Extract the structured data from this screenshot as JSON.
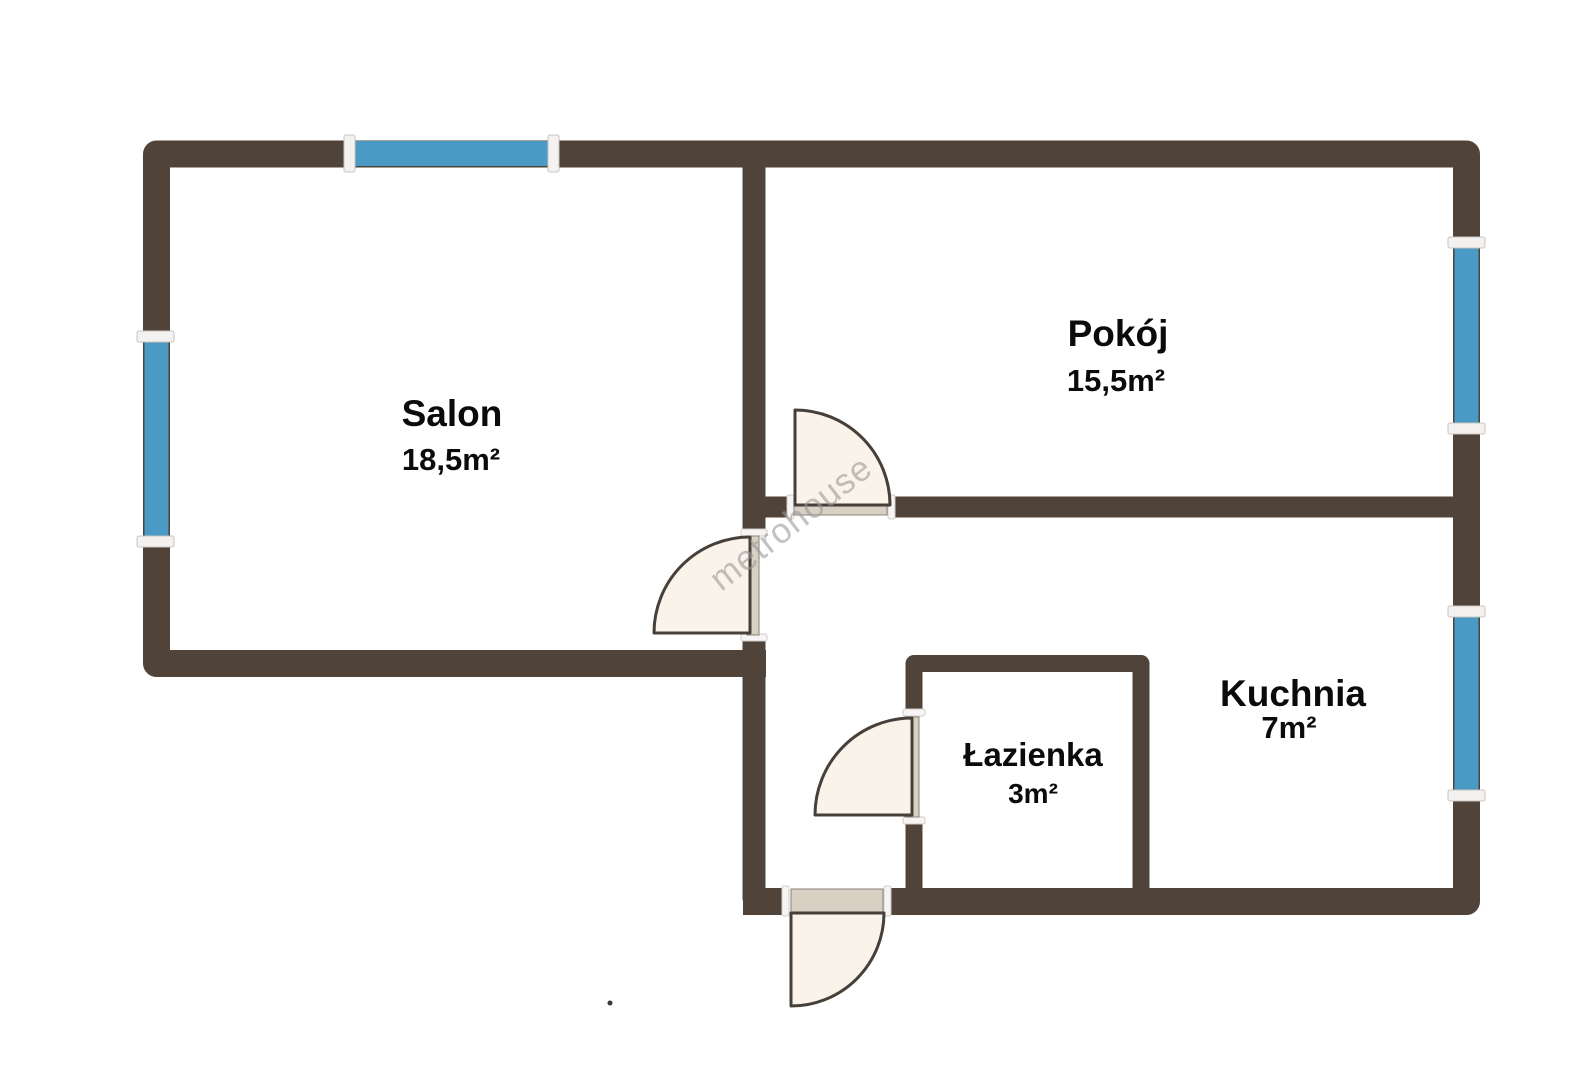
{
  "floorplan": {
    "watermark": "metrohouse",
    "rooms": [
      {
        "id": "salon",
        "name": "Salon",
        "area": "18,5m²"
      },
      {
        "id": "pokoj",
        "name": "Pokój",
        "area": "15,5m²"
      },
      {
        "id": "kuchnia",
        "name": "Kuchnia",
        "area": "7m²"
      },
      {
        "id": "lazienka",
        "name": "Łazienka",
        "area": "3m²"
      }
    ],
    "colors": {
      "background": "#ffffff",
      "wall": "#504339",
      "window": "#4b9ac6",
      "window_cap": "#f4f2f0",
      "door_fill": "#faf3ea",
      "door_leaf": "#d8d0c3",
      "door_stroke": "#47403a",
      "label": "#0b0b0b",
      "watermark": "#9a9a9a"
    }
  }
}
